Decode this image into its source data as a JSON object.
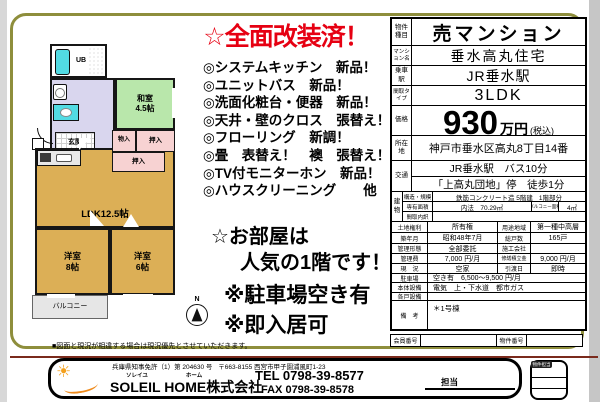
{
  "promo": {
    "title": "☆全面改装済！",
    "bullets": [
      "◎システムキッチン　新品！",
      "◎ユニットバス　新品！",
      "◎洗面化粧台・便器　新品！",
      "◎天井・壁のクロス　張替え！",
      "◎フローリング　新調！",
      "◎畳　表替え！　襖　張替え！",
      "◎TV付モニターホン　新品！",
      "◎ハウスクリーニング　　他"
    ],
    "appeal_line1": "☆お部屋は",
    "appeal_line2": "人気の1階です！",
    "note1": "※駐車場空き有",
    "note2": "※即入居可"
  },
  "floorplan": {
    "ub": "UB",
    "washitsu": "和室",
    "washitsu_size": "4.5帖",
    "genkan": "玄関",
    "monoire": "物入",
    "oshiire1": "押入",
    "oshiire2": "押入",
    "ldk": "LDK12.5帖",
    "yoshitsu8": "洋室",
    "yoshitsu8_size": "8帖",
    "yoshitsu6": "洋室",
    "yoshitsu6_size": "6帖",
    "balcony": "バルコニー",
    "compass_n": "N"
  },
  "disclaimer": "■図面と現況が相違する場合は現況優先とさせていただきます。",
  "property": {
    "type_label": "物件種目",
    "type": "売マンション",
    "name_label": "マンション名",
    "name": "垂水高丸住宅",
    "station_label": "乗車駅",
    "station": "JR垂水駅",
    "layout_label": "間取タイプ",
    "layout": "3LDK",
    "price_label": "価格",
    "price": "930",
    "price_unit": "万円",
    "price_tax": "(税込)",
    "address_label": "所在地",
    "address": "神戸市垂水区高丸8丁目14番",
    "access_label": "交通",
    "access1": "JR垂水駅　バス10分",
    "access2": "「上高丸団地」停　徒歩1分",
    "building_label": "建物",
    "structure_label": "構造・規模",
    "structure": "鉄筋コンクリート造 5階建",
    "floor_part": "1階部分",
    "area_label": "専有面積",
    "area": "内法　70.29㎡",
    "balcony_area_label": "バルコニー面積",
    "balcony_area": "4㎡",
    "madori_label": "間取内訳",
    "madori": "",
    "rows4": [
      {
        "l1": "土地権利",
        "v1": "所有権",
        "l2": "用途地域",
        "v2": "第一種中高層"
      },
      {
        "l1": "築年月",
        "v1": "昭和48年7月",
        "l2": "総戸数",
        "v2": "165戸"
      },
      {
        "l1": "管理形態",
        "v1": "全部委託",
        "l2": "施工会社",
        "v2": ""
      },
      {
        "l1": "管理費",
        "v1": "7,000 円/月",
        "l2": "修繕積立金",
        "v2": "9,000 円/月"
      },
      {
        "l1": "現　況",
        "v1": "空家",
        "l2": "引渡日",
        "v2": "即時"
      }
    ],
    "rows2": [
      {
        "l": "駐車場",
        "v": "空き有　6,500～9,500 円/月"
      },
      {
        "l": "本体設備",
        "v": "電気　上・下水道　都市ガス"
      },
      {
        "l": "各戸設備",
        "v": ""
      }
    ],
    "remarks_label": "備　考",
    "remarks": "＊1号棟",
    "member_label": "会員番号",
    "member": "",
    "listing_label": "物件番号",
    "listing": ""
  },
  "footer": {
    "license": "兵庫県知事免許（1）第 204630 号",
    "office_address": "〒663-8155 西宮市甲子園浦風町1-23",
    "furigana1": "ソレイユ",
    "furigana2": "ホーム",
    "company": "SOLEIL HOME株式会社",
    "tel": "TEL 0798-39-8577",
    "fax": "FAX 0798-39-8578",
    "tanto": "担当",
    "stamp_label": "物件担当"
  },
  "colors": {
    "frame_olive": "#8e8e3c",
    "title_red": "#e60012",
    "tan_room": "#dcaf56",
    "green_room": "#b9e7ab",
    "lavender_hall": "#d9d6ee",
    "pink_closet": "#f7d2d2",
    "cyan_fixture": "#52dbe3",
    "balcony_gray": "#e6e6e6"
  }
}
